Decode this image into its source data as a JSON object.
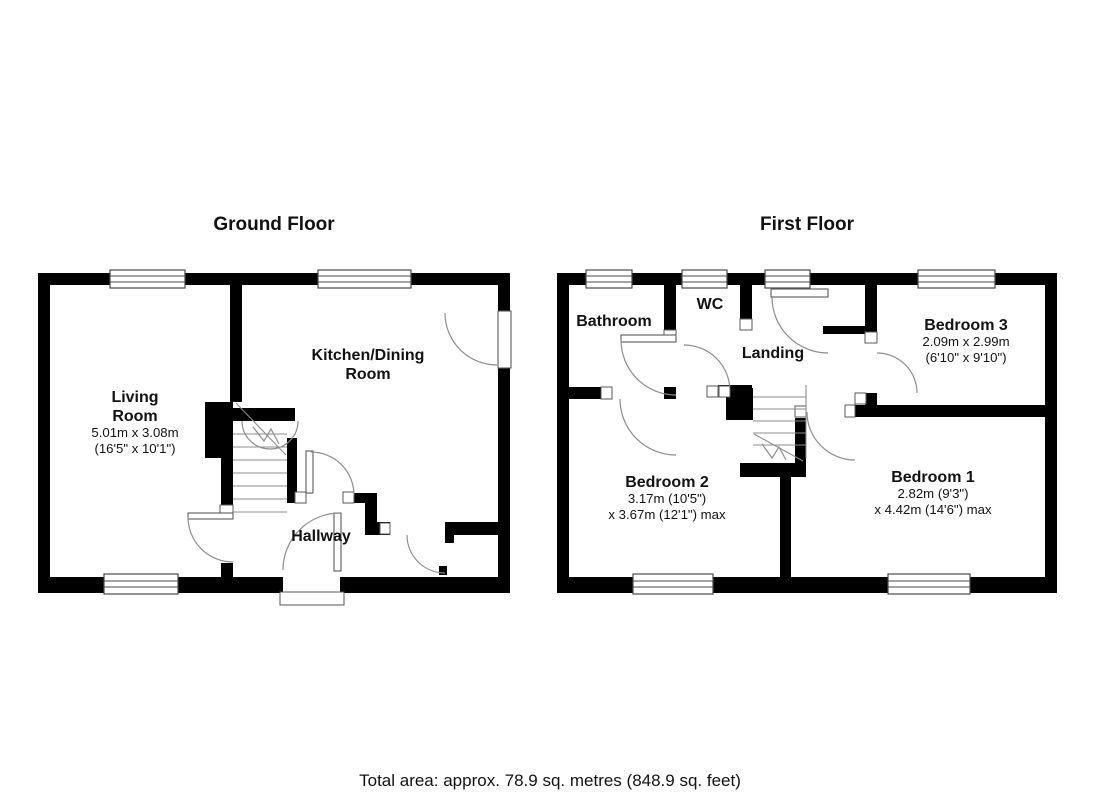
{
  "ground_floor": {
    "title": "Ground Floor",
    "rooms": {
      "living_room": {
        "name_line1": "Living",
        "name_line2": "Room",
        "dim_metric": "5.01m x 3.08m",
        "dim_imperial": "(16'5\" x 10'1\")"
      },
      "kitchen_dining": {
        "name_line1": "Kitchen/Dining",
        "name_line2": "Room"
      },
      "hallway": {
        "name": "Hallway"
      }
    }
  },
  "first_floor": {
    "title": "First Floor",
    "rooms": {
      "bathroom": {
        "name": "Bathroom"
      },
      "wc": {
        "name": "WC"
      },
      "landing": {
        "name": "Landing"
      },
      "bedroom3": {
        "name": "Bedroom 3",
        "dim_metric": "2.09m x 2.99m",
        "dim_imperial": "(6'10\" x 9'10\")"
      },
      "bedroom2": {
        "name": "Bedroom 2",
        "dim_line1": "3.17m (10'5\")",
        "dim_line2": "x 3.67m (12'1\") max"
      },
      "bedroom1": {
        "name": "Bedroom 1",
        "dim_line1": "2.82m (9'3\")",
        "dim_line2": "x 4.42m (14'6\") max"
      }
    }
  },
  "footer": {
    "total_area": "Total area: approx. 78.9 sq. metres (848.9 sq. feet)"
  },
  "colors": {
    "wall": "#000000",
    "background": "#ffffff",
    "fixture_line": "#8d8d8d"
  }
}
